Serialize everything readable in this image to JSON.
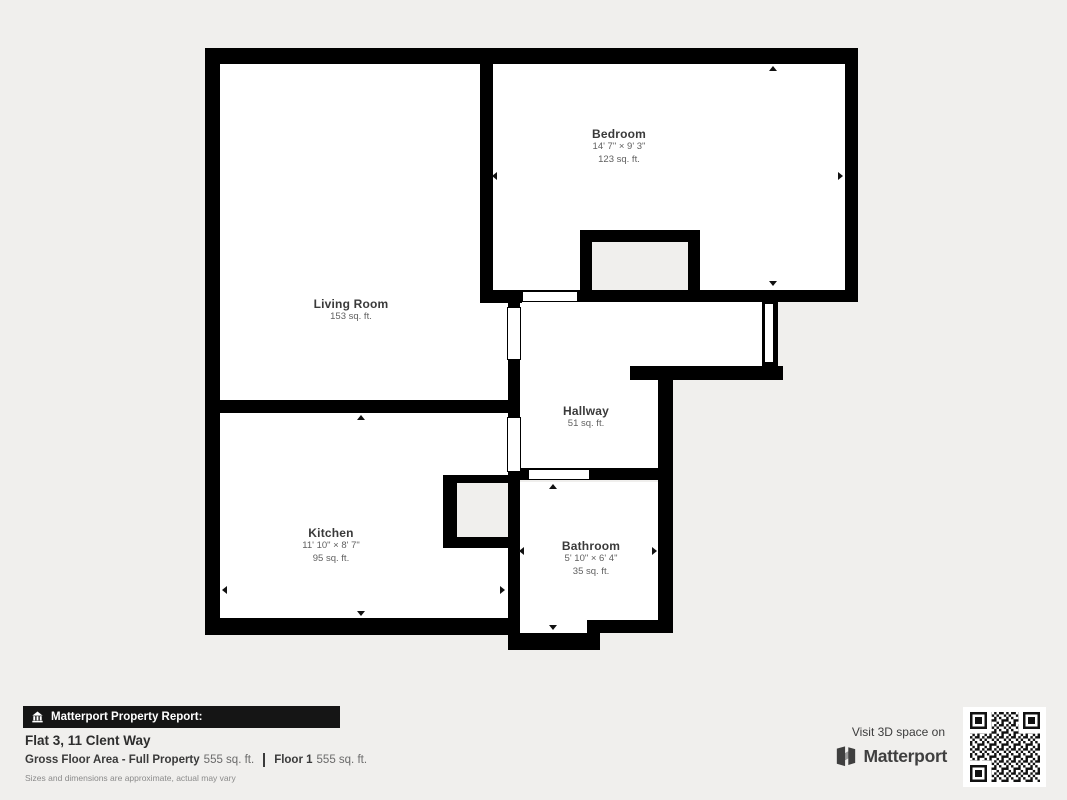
{
  "plan": {
    "colors": {
      "wall": "#000000",
      "floor": "#ffffff",
      "background": "#f0efed"
    },
    "rooms": {
      "living_room": {
        "name": "Living Room",
        "area": "153 sq. ft."
      },
      "bedroom": {
        "name": "Bedroom",
        "dims": "14' 7\" × 9' 3\"",
        "area": "123 sq. ft."
      },
      "hallway": {
        "name": "Hallway",
        "area": "51 sq. ft."
      },
      "kitchen": {
        "name": "Kitchen",
        "dims": "11' 10\" × 8' 7\"",
        "area": "95 sq. ft."
      },
      "bathroom": {
        "name": "Bathroom",
        "dims": "5' 10\" × 6' 4\"",
        "area": "35 sq. ft."
      }
    }
  },
  "footer": {
    "report_badge": "Matterport Property Report:",
    "address": "Flat 3, 11 Clent Way",
    "gross_label": "Gross Floor Area - Full Property",
    "gross_value": "555 sq. ft.",
    "floor_label": "Floor 1",
    "floor_value": "555 sq. ft.",
    "disclaimer": "Sizes and dimensions are approximate, actual may vary"
  },
  "cta": {
    "visit_text": "Visit 3D space on",
    "brand": "Matterport"
  }
}
